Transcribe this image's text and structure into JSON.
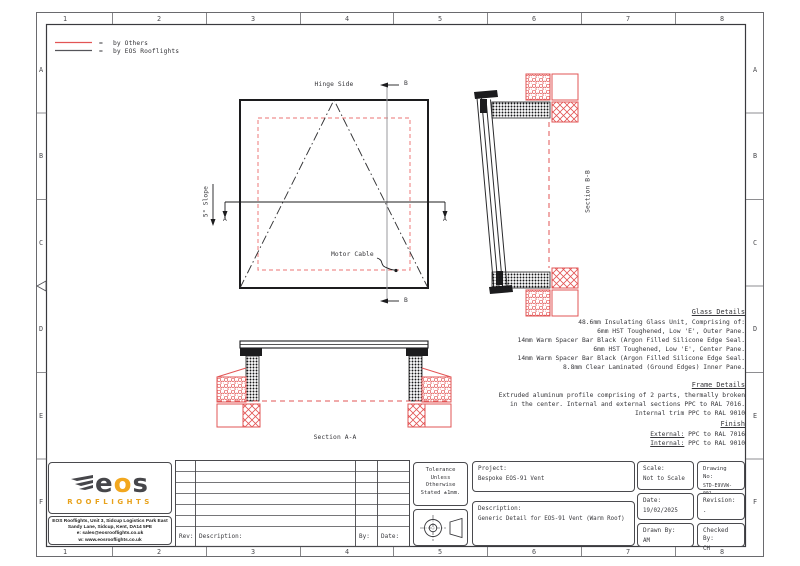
{
  "colors": {
    "by_others_red": "#e25555",
    "by_eos_black": "#2a2a2c",
    "logo_yellow": "#f2a71e",
    "logo_dark": "#46464a"
  },
  "legend": {
    "eq": "=",
    "items": [
      {
        "label": "by Others"
      },
      {
        "label": "by EOS Rooflights"
      }
    ]
  },
  "grid": {
    "columns": [
      "1",
      "2",
      "3",
      "4",
      "5",
      "6",
      "7",
      "8"
    ],
    "rows": [
      "A",
      "B",
      "C",
      "D",
      "E",
      "F"
    ]
  },
  "plan": {
    "hinge": "Hinge Side",
    "slope": "5° Slope",
    "motor": "Motor Cable",
    "marker_a": "A",
    "marker_b": "B"
  },
  "sections": {
    "bb": "Section B-B",
    "aa": "Section A-A"
  },
  "notes": {
    "glass": {
      "title": "Glass Details",
      "lines": [
        "48.6mm Insulating Glass Unit, Comprising of:",
        "6mm HST Toughened, Low 'E', Outer Pane.",
        "14mm Warm Spacer Bar Black (Argon Filled Silicone Edge Seal.",
        "6mm HST Toughened, Low 'E', Center Pane.",
        "14mm Warm Spacer Bar Black (Argon Filled Silicone Edge Seal.",
        "8.8mm Clear Laminated (Ground Edges) Inner Pane."
      ]
    },
    "frame": {
      "title": "Frame Details",
      "lines": [
        "Extruded aluminum profile comprising of 2 parts, thermally broken",
        "in the center. Internal and external sections PPC to RAL 7016.",
        "Internal trim PPC to RAL 9010"
      ]
    },
    "finish": {
      "title": "Finish",
      "items": [
        {
          "k": "External:",
          "v": " PPC to RAL 7016"
        },
        {
          "k": "Internal:",
          "v": " PPC to RAL 9010"
        }
      ]
    }
  },
  "titleblock": {
    "logo": {
      "parts": [
        "e",
        "o",
        "s"
      ],
      "sub": "ROOFLIGHTS"
    },
    "address": [
      "EOS Rooflights, Unit 3, Sidcup Logistics Park East",
      "Sandy Lane, Sidcup, Kent, DA14 5PE",
      "e: sales@eosrooflights.co.uk",
      "w: www.eosrooflights.co.uk"
    ],
    "rev_table": {
      "rev": "Rev:",
      "description": "Description:",
      "by": "By:",
      "date": "Date:"
    },
    "tolerance_lines": [
      "Tolerance",
      "Unless",
      "Otherwise",
      "Stated ±1mm."
    ],
    "project": {
      "label": "Project:",
      "value": "Bespoke EOS-91 Vent"
    },
    "description": {
      "label": "Description:",
      "value": "Generic Detail for EOS-91 Vent (Warm Roof)"
    },
    "scale": {
      "label": "Scale:",
      "value": "Not to Scale"
    },
    "drawing_no": {
      "label": "Drawing No:",
      "value": "STD-E9VVW-001"
    },
    "date": {
      "label": "Date:",
      "value": "19/02/2025"
    },
    "revision": {
      "label": "Revision:",
      "value": "."
    },
    "drawn_by": {
      "label": "Drawn By:",
      "value": "AM"
    },
    "checked_by": {
      "label": "Checked By:",
      "value": "CH"
    }
  },
  "icons": {
    "wing": "wing-icon",
    "projection": "third-angle-projection-icon",
    "datum": "datum-triangle-icon"
  }
}
